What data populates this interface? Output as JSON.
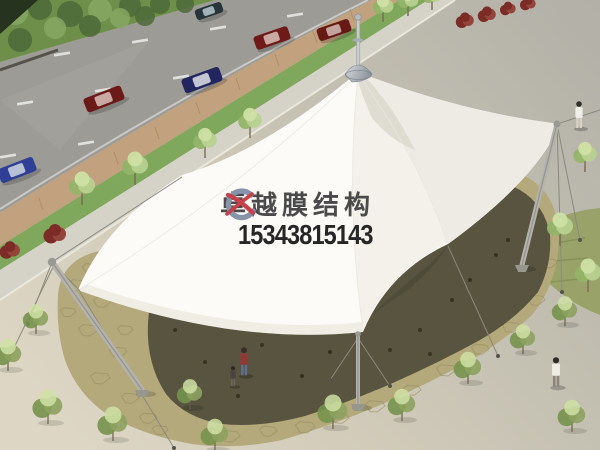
{
  "watermark": {
    "brand_text": "卓越膜结构",
    "phone_number": "15343815143",
    "brand_color": "#4a4a4a",
    "phone_color": "#262626",
    "logo": {
      "crescent_color": "#8793ab",
      "swoosh_color": "#c7414c"
    }
  },
  "scene": {
    "colors": {
      "plaza_top": "#b2b0a7",
      "plaza_mid": "#c6c2b4",
      "sand_bottom": "#ddd6c4",
      "asphalt": "#9c9b96",
      "hedge": "#6d8f4a",
      "hedge_dark": "#4c6a38",
      "hedge_corner": "#26331f",
      "brick_strip": "#c2a17e",
      "brick_joint": "#a8865e",
      "grass_strip": "#7fa85c",
      "walkway": "#d5d2c8",
      "lawn": "#99a369",
      "lawn_streak": "#7e8c52",
      "paving": "#b3a97b",
      "stone_line": "#948a5e",
      "shadow": "#514e3a",
      "debris": "#2d2a1c",
      "membrane": "#fcfbf8",
      "membrane_east": "#edebe3",
      "membrane_se": "#f3f1ea",
      "membrane_dark": "#d9d7cc",
      "gap_shadow": "#4e4b38",
      "mast": "#b3b2ac",
      "cable": "#8b897e",
      "lane_dash": "#e8e8e4",
      "tree_leaf": "#b7d18f",
      "tree_leaf_dark": "#94b469",
      "tree_leaf_light": "#cfe0a4",
      "shrub_leaf": "#8da15f",
      "shrub_leaf_dark": "#75924d",
      "red_bush": "#7c2b26",
      "red_bush_light": "#93453c"
    },
    "lane_dashes": [
      [
        62,
        54
      ],
      [
        140,
        41
      ],
      [
        218,
        28
      ],
      [
        295,
        15
      ],
      [
        25,
        103
      ],
      [
        103,
        90
      ],
      [
        181,
        77
      ],
      [
        8,
        156
      ],
      [
        86,
        143
      ]
    ],
    "brick_joints": [
      [
        39,
        204
      ],
      [
        77,
        181
      ],
      [
        114,
        158
      ],
      [
        155,
        133
      ],
      [
        196,
        108
      ],
      [
        236,
        84
      ],
      [
        275,
        60
      ],
      [
        313,
        37
      ],
      [
        350,
        15
      ]
    ],
    "hedge_blobs": [
      [
        15,
        12,
        13
      ],
      [
        40,
        8,
        12
      ],
      [
        70,
        14,
        13
      ],
      [
        100,
        10,
        12
      ],
      [
        130,
        6,
        11
      ],
      [
        160,
        4,
        10
      ],
      [
        55,
        28,
        11
      ],
      [
        20,
        40,
        12
      ],
      [
        90,
        26,
        11
      ],
      [
        120,
        18,
        10
      ],
      [
        185,
        4,
        9
      ],
      [
        145,
        16,
        10
      ]
    ],
    "cars": [
      {
        "x": 17,
        "y": 170,
        "rot": -21,
        "w": 38,
        "h": 15,
        "body": "#2f3f96",
        "roof": "#b8c0d6",
        "label": "blue-car"
      },
      {
        "x": 104,
        "y": 99,
        "rot": -21,
        "w": 40,
        "h": 15,
        "body": "#6b1a17",
        "roof": "#caa9a4",
        "label": "dark-red-car"
      },
      {
        "x": 202,
        "y": 80,
        "rot": -20,
        "w": 40,
        "h": 15,
        "body": "#23255f",
        "roof": "#c2c6d2",
        "label": "dark-blue-car"
      },
      {
        "x": 272,
        "y": 38,
        "rot": -19,
        "w": 36,
        "h": 14,
        "body": "#6e1b18",
        "roof": "#c9a9a2",
        "label": "dark-red-car"
      },
      {
        "x": 334,
        "y": 30,
        "rot": -19,
        "w": 34,
        "h": 13,
        "body": "#671916",
        "roof": "#c4a39e",
        "label": "dark-red-car"
      },
      {
        "x": 209,
        "y": 11,
        "rot": -19,
        "w": 28,
        "h": 11,
        "body": "#27343a",
        "roof": "#9fb3b8",
        "label": "dark-car"
      }
    ],
    "street_trees": [
      [
        82,
        205,
        10
      ],
      [
        135,
        185,
        10
      ],
      [
        205,
        158,
        9
      ],
      [
        250,
        138,
        9
      ],
      [
        383,
        22,
        8
      ],
      [
        408,
        16,
        8
      ],
      [
        432,
        10,
        7
      ]
    ],
    "lawn_trees": [
      [
        585,
        172,
        9
      ],
      [
        560,
        246,
        10
      ],
      [
        588,
        292,
        10
      ]
    ],
    "shrubs": [
      [
        8,
        367,
        12
      ],
      [
        36,
        330,
        11
      ],
      [
        48,
        420,
        13
      ],
      [
        113,
        437,
        13
      ],
      [
        190,
        405,
        11
      ],
      [
        215,
        447,
        12
      ],
      [
        333,
        425,
        13
      ],
      [
        402,
        417,
        12
      ],
      [
        468,
        380,
        12
      ],
      [
        523,
        350,
        11
      ],
      [
        565,
        322,
        11
      ],
      [
        572,
        428,
        12
      ]
    ],
    "red_bushes": [
      [
        10,
        252,
        9
      ],
      [
        55,
        236,
        10
      ],
      [
        465,
        22,
        8
      ],
      [
        487,
        16,
        8
      ],
      [
        508,
        10,
        7
      ],
      [
        528,
        5,
        7
      ]
    ],
    "paving_stones": [
      [
        78,
        285,
        10
      ],
      [
        102,
        302,
        9
      ],
      [
        88,
        330,
        10
      ],
      [
        118,
        352,
        9
      ],
      [
        100,
        378,
        10
      ],
      [
        130,
        398,
        9
      ],
      [
        68,
        312,
        8
      ],
      [
        125,
        330,
        8
      ],
      [
        148,
        418,
        9
      ],
      [
        230,
        436,
        10
      ],
      [
        268,
        431,
        9
      ],
      [
        305,
        427,
        10
      ],
      [
        340,
        418,
        9
      ],
      [
        375,
        406,
        10
      ],
      [
        412,
        390,
        9
      ],
      [
        446,
        370,
        10
      ],
      [
        480,
        349,
        9
      ],
      [
        511,
        327,
        9
      ],
      [
        536,
        300,
        9
      ],
      [
        549,
        263,
        8
      ],
      [
        90,
        268,
        8
      ],
      [
        160,
        430,
        8
      ]
    ],
    "debris": [
      [
        175,
        330
      ],
      [
        205,
        362
      ],
      [
        238,
        396
      ],
      [
        262,
        345
      ],
      [
        290,
        312
      ],
      [
        302,
        376
      ],
      [
        330,
        352
      ],
      [
        358,
        392
      ],
      [
        390,
        350
      ],
      [
        420,
        330
      ],
      [
        452,
        300
      ],
      [
        470,
        280
      ],
      [
        496,
        255
      ],
      [
        332,
        300
      ],
      [
        232,
        312
      ],
      [
        430,
        354
      ],
      [
        508,
        240
      ],
      [
        198,
        398
      ],
      [
        300,
        255
      ],
      [
        360,
        270
      ]
    ],
    "masts": [
      {
        "x1": 52,
        "y1": 262,
        "x2": 142,
        "y2": 390,
        "w": 6,
        "label": "left-mast"
      },
      {
        "x1": 557,
        "y1": 124,
        "x2": 522,
        "y2": 265,
        "w": 5,
        "label": "right-mast"
      },
      {
        "x1": 358,
        "y1": 334,
        "x2": 358,
        "y2": 404,
        "w": 4,
        "label": "front-strut-mast"
      }
    ],
    "cables": [
      [
        52,
        262,
        182,
        177
      ],
      [
        52,
        262,
        80,
        291
      ],
      [
        52,
        262,
        28,
        324
      ],
      [
        54,
        265,
        12,
        352
      ],
      [
        80,
        292,
        174,
        448
      ],
      [
        358,
        338,
        390,
        386
      ],
      [
        358,
        338,
        330,
        380
      ],
      [
        557,
        124,
        600,
        110
      ],
      [
        557,
        124,
        580,
        240
      ],
      [
        557,
        124,
        562,
        292
      ],
      [
        448,
        246,
        498,
        356
      ]
    ],
    "anchors": [
      [
        28,
        324
      ],
      [
        12,
        352
      ],
      [
        174,
        448
      ],
      [
        390,
        386
      ],
      [
        330,
        380
      ],
      [
        580,
        240
      ],
      [
        562,
        292
      ],
      [
        498,
        356
      ]
    ],
    "people": [
      {
        "x": 244,
        "y": 347,
        "s": 1.05,
        "hair": "#3a2e28",
        "top": "#8e3a34",
        "bottom": "#5d6e91",
        "label": "adult-visitor"
      },
      {
        "x": 233,
        "y": 366,
        "s": 0.75,
        "hair": "#332a24",
        "top": "#4a4440",
        "bottom": "#6b625a",
        "label": "child-visitor"
      },
      {
        "x": 556,
        "y": 357,
        "s": 1.1,
        "hair": "#2f2a26",
        "top": "#efece4",
        "bottom": "#8b857c",
        "label": "person-white-coat"
      },
      {
        "x": 579,
        "y": 101,
        "s": 1.0,
        "hair": "#33302c",
        "top": "#f0eee8",
        "bottom": "#d6d2c6",
        "label": "person-walking"
      }
    ]
  }
}
